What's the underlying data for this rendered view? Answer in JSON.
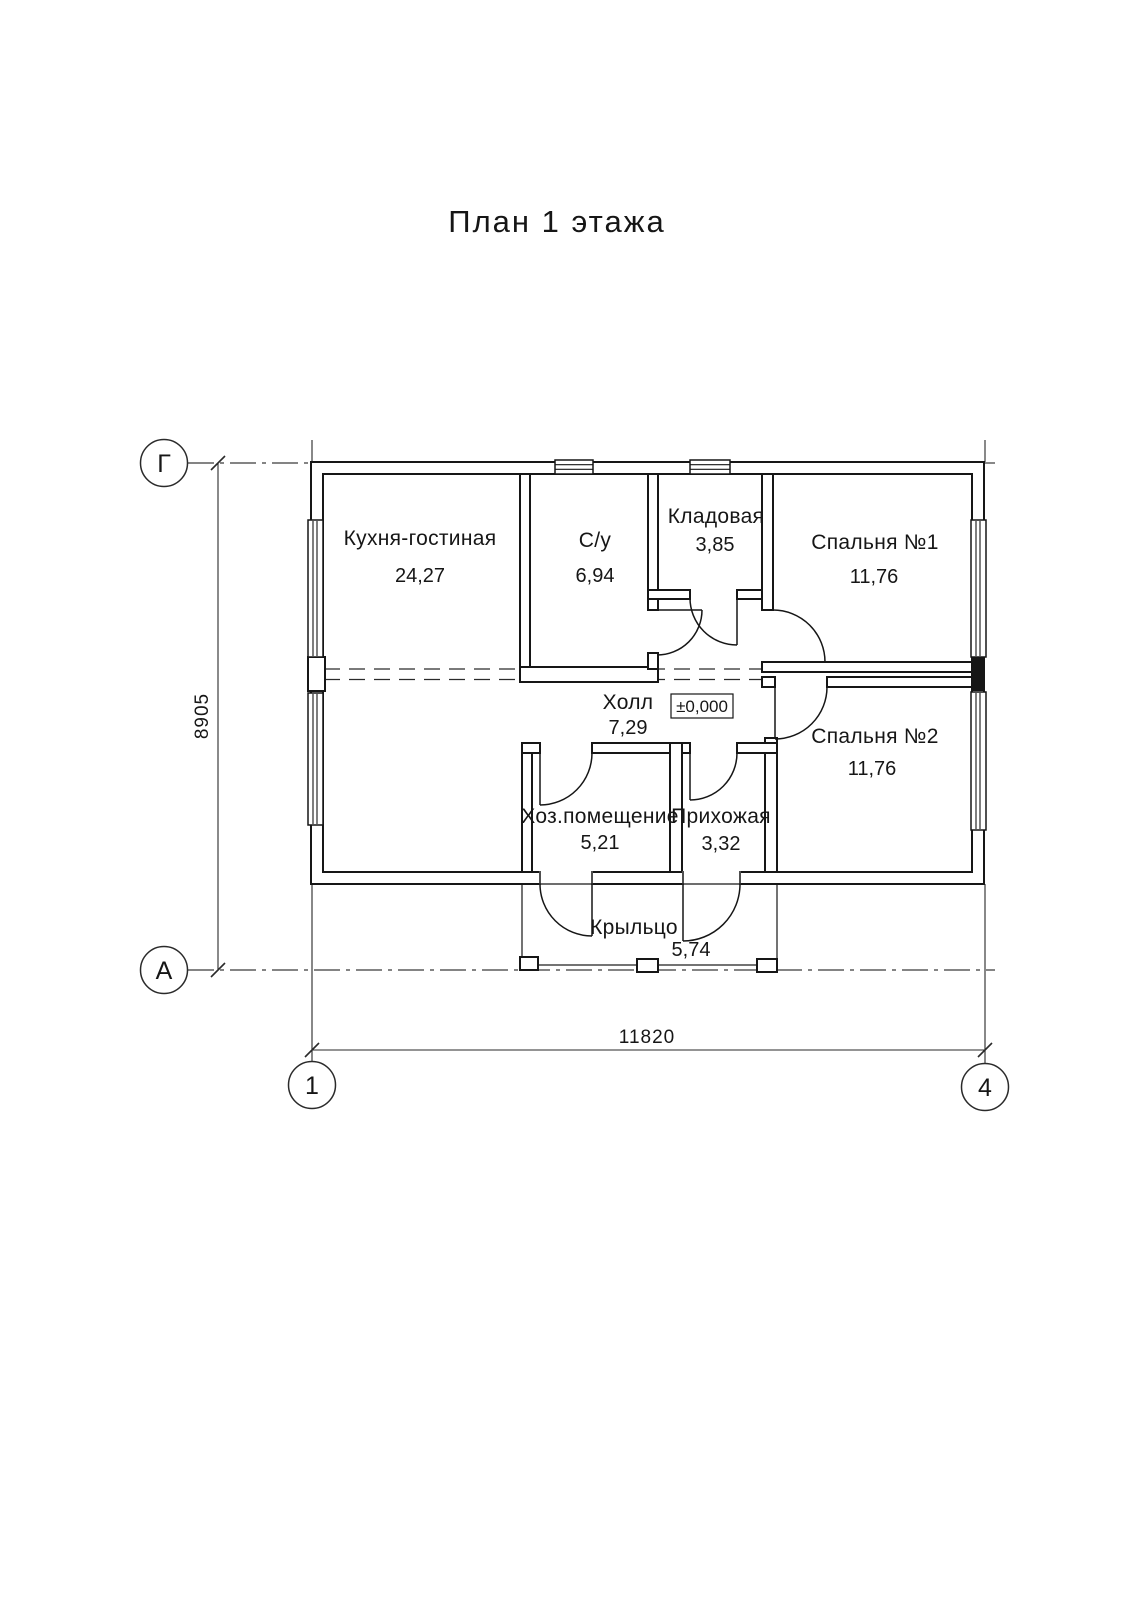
{
  "title": "План 1 этажа",
  "level_mark": "±0,000",
  "rooms": [
    {
      "id": "kitchen-living",
      "name": "Кухня-гостиная",
      "area": "24,27"
    },
    {
      "id": "bathroom",
      "name": "С/у",
      "area": "6,94"
    },
    {
      "id": "storage",
      "name": "Кладовая",
      "area": "3,85"
    },
    {
      "id": "bedroom-1",
      "name": "Спальня №1",
      "area": "11,76"
    },
    {
      "id": "hall",
      "name": "Холл",
      "area": "7,29"
    },
    {
      "id": "bedroom-2",
      "name": "Спальня №2",
      "area": "11,76"
    },
    {
      "id": "utility",
      "name": "Хоз.помещение",
      "area": "5,21"
    },
    {
      "id": "entry",
      "name": "Прихожая",
      "area": "3,32"
    },
    {
      "id": "porch",
      "name": "Крыльцо",
      "area": "5,74"
    }
  ],
  "axes": {
    "row_top": "Г",
    "row_bottom": "А",
    "col_left": "1",
    "col_right": "4"
  },
  "dimensions": {
    "overall_width": "11820",
    "overall_height": "8905"
  },
  "colors": {
    "line": "#161616",
    "background": "#ffffff"
  }
}
